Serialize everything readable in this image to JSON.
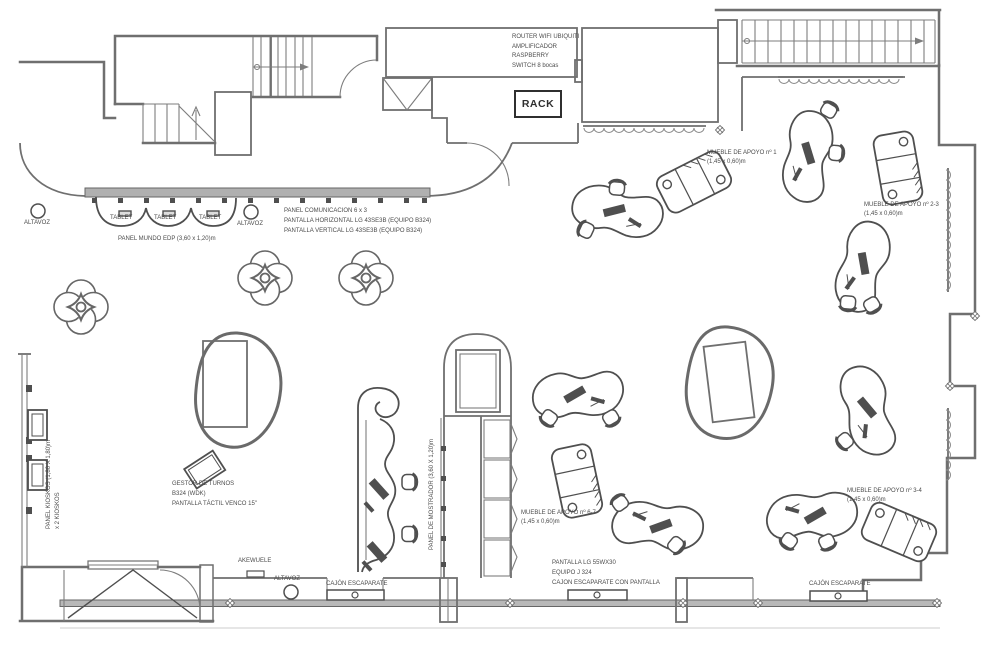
{
  "colors": {
    "wall": "#6f6f6f",
    "furniture": "#4f4f4f",
    "accent_dark": "#2f2f2f",
    "wall_fill": "#b8b8b8",
    "background": "#ffffff"
  },
  "rack": {
    "equipment": [
      "ROUTER WIFI UBIQUITI",
      "AMPLIFICADOR",
      "RASPBERRY",
      "SWITCH 8 bocas"
    ],
    "label": "RACK"
  },
  "top_left": {
    "speaker_left": "ALTAVOZ",
    "speaker_right": "ALTAVOZ",
    "tablets": [
      "TABLET",
      "TABLET",
      "TABLET"
    ],
    "panel_mundo": "PANEL MUNDO EDP (3,60 x 1,20)m",
    "panel_comunicacion": [
      "PANEL COMUNICACION 6 x 3",
      "PANTALLA HORIZONTAL LG 43SE3B  (EQUIPO B324)",
      "PANTALLA VERTICAL LG 43SE3B  (EQUIPO B324)"
    ]
  },
  "left": {
    "panel_kioskos": [
      "PANEL KIOSKOS (1,80 X 1,80)m",
      "x 2 KIOSKOS"
    ]
  },
  "center": {
    "gestor_turnos": [
      "GESTOR DE TURNOS",
      "B324 (WDK)",
      "PANTALLA TÁCTIL VENCO 15\""
    ],
    "panel_mostrador": "PANEL DE MOSTRADOR (3,60 X 1,20)m"
  },
  "muebles": {
    "n1": [
      "MUEBLE DE APOYO nº 1",
      "(1,45 x 0,60)m"
    ],
    "n2_3": [
      "MUEBLE DE APOYO nº 2-3",
      "(1,45 x 0,60)m"
    ],
    "n6_7": [
      "MUEBLE DE APOYO nº 6-7",
      "(1,45 x 0,60)m"
    ],
    "n3_4": [
      "MUEBLE DE APOYO nº 3-4",
      "(1,45 x 0,60)m"
    ]
  },
  "bottom": {
    "akewuele": "AKEWUELE",
    "speaker": "ALTAVOZ",
    "cajon_left": "CAJÓN ESCAPARATE",
    "cajon_right": "CAJÓN ESCAPARATE",
    "display_block": [
      "PANTALLA LG 55WX30",
      "EQUIPO J 324",
      "CAJON ESCAPARATE CON PANTALLA"
    ]
  }
}
